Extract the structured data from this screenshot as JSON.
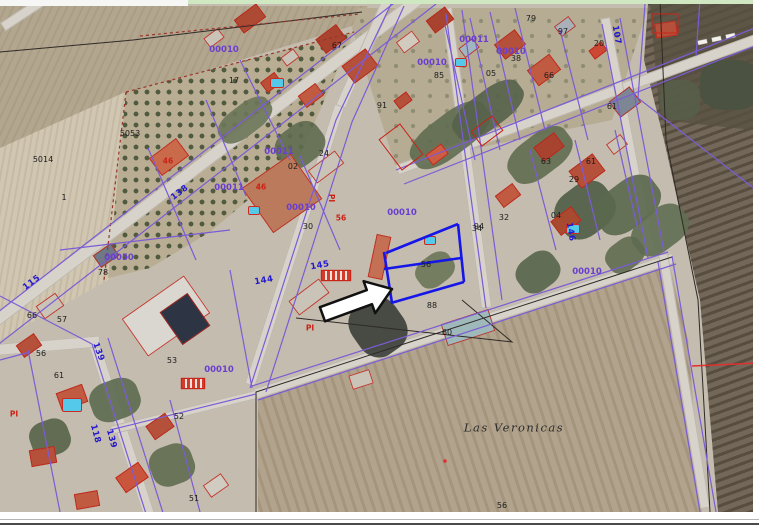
{
  "map": {
    "region_name": "Las Veronicas",
    "block_codes": [
      "00010",
      "00011",
      "00050"
    ],
    "road_numbers": [
      "107",
      "115",
      "118",
      "138",
      "139",
      "144",
      "145",
      "146"
    ],
    "colors": {
      "parcel_boundary": "#7b5cd6",
      "selected_parcel": "#1616e8",
      "building_outline": "#c82418",
      "road_label": "#2118cf",
      "block_label": "#6a3fd0",
      "parcel_label": "#1c1c1c"
    },
    "labels": [
      {
        "text": "5014",
        "x": 43,
        "y": 160,
        "type": "black"
      },
      {
        "text": "5053",
        "x": 130,
        "y": 134,
        "type": "black"
      },
      {
        "text": "1",
        "x": 64,
        "y": 198,
        "type": "black"
      },
      {
        "text": "17",
        "x": 234,
        "y": 81,
        "type": "black"
      },
      {
        "text": "67",
        "x": 337,
        "y": 46,
        "type": "black"
      },
      {
        "text": "91",
        "x": 382,
        "y": 106,
        "type": "black"
      },
      {
        "text": "79",
        "x": 531,
        "y": 19,
        "type": "black"
      },
      {
        "text": "97",
        "x": 563,
        "y": 32,
        "type": "black"
      },
      {
        "text": "85",
        "x": 439,
        "y": 76,
        "type": "black"
      },
      {
        "text": "05",
        "x": 491,
        "y": 74,
        "type": "black"
      },
      {
        "text": "38",
        "x": 516,
        "y": 59,
        "type": "black"
      },
      {
        "text": "66",
        "x": 549,
        "y": 76,
        "type": "black"
      },
      {
        "text": "20",
        "x": 599,
        "y": 44,
        "type": "black"
      },
      {
        "text": "61",
        "x": 612,
        "y": 107,
        "type": "black"
      },
      {
        "text": "02",
        "x": 293,
        "y": 167,
        "type": "black"
      },
      {
        "text": "24",
        "x": 324,
        "y": 154,
        "type": "black"
      },
      {
        "text": "63",
        "x": 546,
        "y": 162,
        "type": "black"
      },
      {
        "text": "29",
        "x": 574,
        "y": 180,
        "type": "black"
      },
      {
        "text": "61",
        "x": 591,
        "y": 162,
        "type": "black"
      },
      {
        "text": "94",
        "x": 479,
        "y": 227,
        "type": "black"
      },
      {
        "text": "32",
        "x": 504,
        "y": 218,
        "type": "black"
      },
      {
        "text": "04",
        "x": 556,
        "y": 216,
        "type": "black"
      },
      {
        "text": "30",
        "x": 308,
        "y": 227,
        "type": "black"
      },
      {
        "text": "34",
        "x": 477,
        "y": 229,
        "type": "black"
      },
      {
        "text": "56",
        "x": 426,
        "y": 265,
        "type": "black"
      },
      {
        "text": "88",
        "x": 432,
        "y": 306,
        "type": "black"
      },
      {
        "text": "60",
        "x": 447,
        "y": 333,
        "type": "black"
      },
      {
        "text": "78",
        "x": 103,
        "y": 273,
        "type": "black"
      },
      {
        "text": "66",
        "x": 32,
        "y": 316,
        "type": "black"
      },
      {
        "text": "57",
        "x": 62,
        "y": 320,
        "type": "black"
      },
      {
        "text": "56",
        "x": 41,
        "y": 354,
        "type": "black"
      },
      {
        "text": "61",
        "x": 59,
        "y": 376,
        "type": "black"
      },
      {
        "text": "53",
        "x": 172,
        "y": 361,
        "type": "black"
      },
      {
        "text": "52",
        "x": 179,
        "y": 417,
        "type": "black"
      },
      {
        "text": "51",
        "x": 194,
        "y": 499,
        "type": "black"
      },
      {
        "text": "56",
        "x": 502,
        "y": 506,
        "type": "black"
      },
      {
        "text": "Las Veronicas",
        "x": 514,
        "y": 428,
        "type": "place"
      },
      {
        "text": "00010",
        "x": 224,
        "y": 50,
        "type": "purple"
      },
      {
        "text": "00011",
        "x": 474,
        "y": 40,
        "type": "purple"
      },
      {
        "text": "00010",
        "x": 432,
        "y": 63,
        "type": "purple"
      },
      {
        "text": "00010",
        "x": 511,
        "y": 52,
        "type": "purple"
      },
      {
        "text": "00011",
        "x": 279,
        "y": 152,
        "type": "purple"
      },
      {
        "text": "00011",
        "x": 229,
        "y": 188,
        "type": "purple"
      },
      {
        "text": "00010",
        "x": 301,
        "y": 208,
        "type": "purple"
      },
      {
        "text": "00010",
        "x": 402,
        "y": 213,
        "type": "purple"
      },
      {
        "text": "00010",
        "x": 587,
        "y": 272,
        "type": "purple"
      },
      {
        "text": "00050",
        "x": 119,
        "y": 258,
        "type": "purple"
      },
      {
        "text": "00010",
        "x": 219,
        "y": 370,
        "type": "purple"
      },
      {
        "text": "115",
        "x": 32,
        "y": 283,
        "type": "blue",
        "rot": -37
      },
      {
        "text": "138",
        "x": 180,
        "y": 193,
        "type": "blue",
        "rot": -37
      },
      {
        "text": "145",
        "x": 320,
        "y": 266,
        "type": "blue",
        "rot": -10
      },
      {
        "text": "144",
        "x": 264,
        "y": 281,
        "type": "blue",
        "rot": -10
      },
      {
        "text": "146",
        "x": 570,
        "y": 232,
        "type": "blue",
        "rot": 80
      },
      {
        "text": "107",
        "x": 616,
        "y": 35,
        "type": "blue",
        "rot": 80
      },
      {
        "text": "139",
        "x": 98,
        "y": 352,
        "type": "blue",
        "rot": 70
      },
      {
        "text": "118",
        "x": 95,
        "y": 434,
        "type": "blue",
        "rot": 75
      },
      {
        "text": "139",
        "x": 111,
        "y": 439,
        "type": "blue",
        "rot": 75
      },
      {
        "text": "46",
        "x": 168,
        "y": 161,
        "type": "red"
      },
      {
        "text": "46",
        "x": 261,
        "y": 187,
        "type": "red"
      },
      {
        "text": "56",
        "x": 341,
        "y": 218,
        "type": "red"
      },
      {
        "text": "PI",
        "x": 331,
        "y": 198,
        "type": "red",
        "rot": 90
      },
      {
        "text": "PI",
        "x": 14,
        "y": 414,
        "type": "red"
      },
      {
        "text": "PI",
        "x": 310,
        "y": 328,
        "type": "red"
      }
    ]
  }
}
